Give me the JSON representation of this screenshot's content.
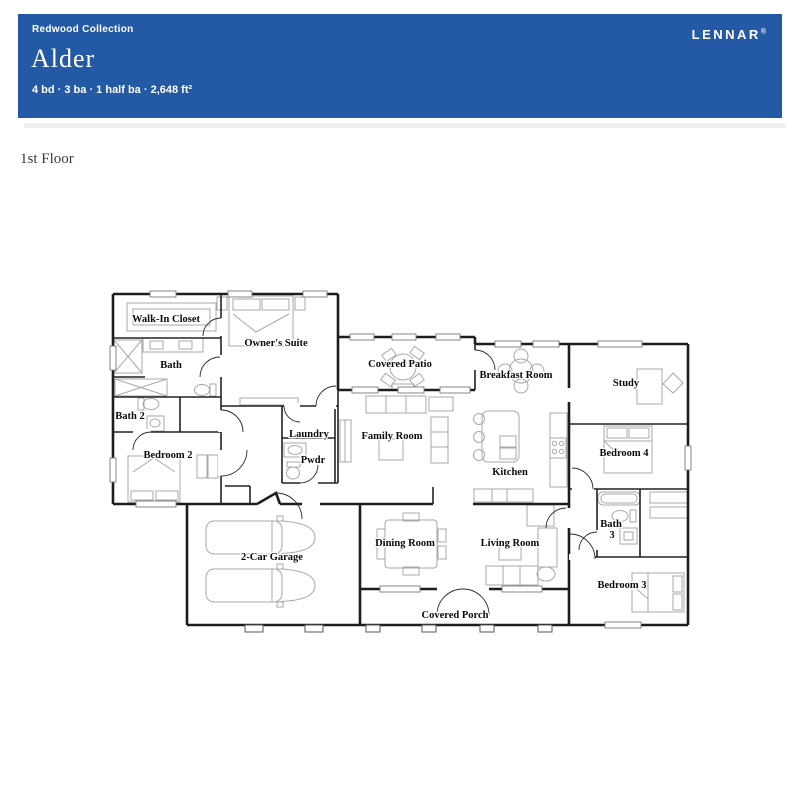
{
  "header": {
    "collection_label": "Redwood Collection",
    "plan_name": "Alder",
    "specs": "4 bd · 3 ba · 1 half ba · 2,648 ft²",
    "brand": "LENNAR",
    "brand_mark": "®",
    "background_color": "#2459a6",
    "text_color": "#ffffff"
  },
  "page": {
    "floor_label": "1st Floor",
    "background_color": "#ffffff"
  },
  "floor_plan": {
    "rooms": [
      {
        "label": "Walk-In Closet"
      },
      {
        "label": "Owner's Suite"
      },
      {
        "label": "Bath"
      },
      {
        "label": "Bath 2"
      },
      {
        "label": "Bedroom 2"
      },
      {
        "label": "Laundry"
      },
      {
        "label": "Pwdr"
      },
      {
        "label": "Covered Patio"
      },
      {
        "label": "Family Room"
      },
      {
        "label": "Breakfast Room"
      },
      {
        "label": "Kitchen"
      },
      {
        "label": "Study"
      },
      {
        "label": "Bedroom 4"
      },
      {
        "label": "Bath"
      },
      {
        "label": "3"
      },
      {
        "label": "Bedroom 3"
      },
      {
        "label": "2-Car Garage"
      },
      {
        "label": "Dining Room"
      },
      {
        "label": "Living Room"
      },
      {
        "label": "Covered Porch"
      }
    ]
  }
}
